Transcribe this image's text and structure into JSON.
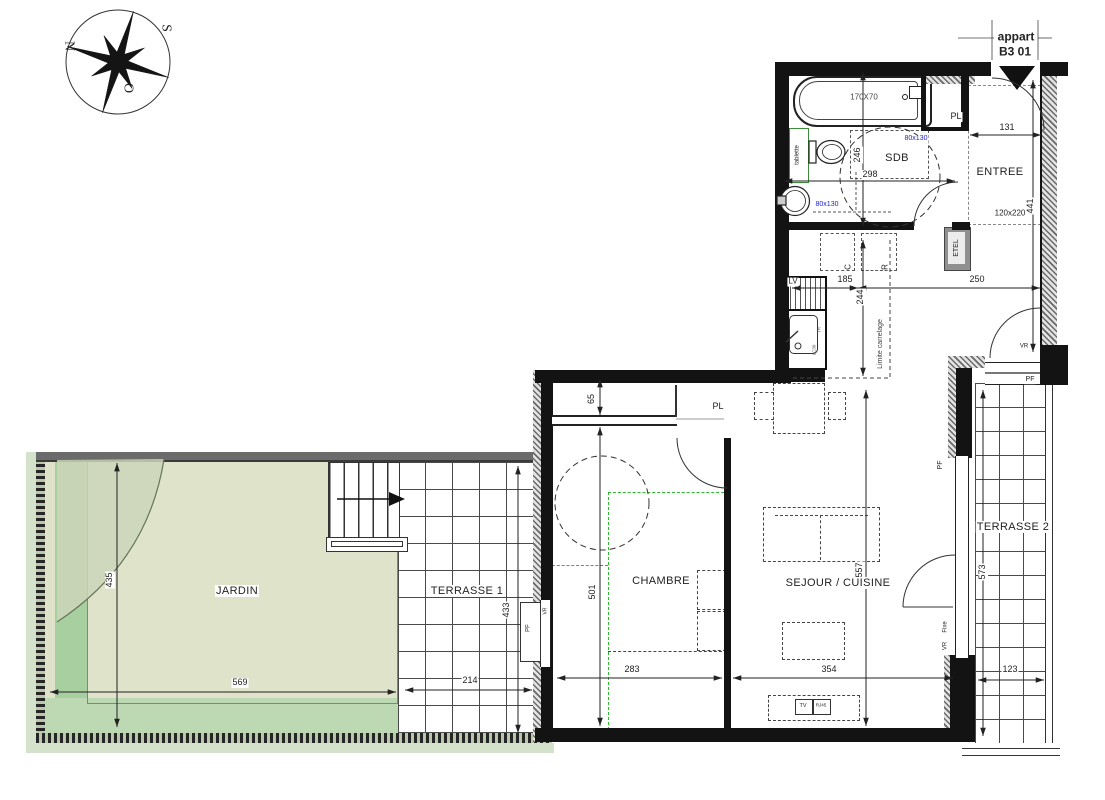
{
  "meta": {
    "apartment_line1": "appart",
    "apartment_line2": "B3 01"
  },
  "compass": {
    "n": "N",
    "s": "S",
    "o": "O"
  },
  "rooms": {
    "jardin": "JARDIN",
    "terrasse1": "TERRASSE 1",
    "terrasse2": "TERRASSE 2",
    "chambre": "CHAMBRE",
    "sejour": "SEJOUR / CUISINE",
    "sdb": "SDB",
    "entree": "ENTREE"
  },
  "dims": {
    "entree_width": "131",
    "entree_height": "441",
    "hall_width": "250",
    "sdb_width": "298",
    "sdb_height": "246",
    "kitchen_width": "185",
    "kitchen_depth": "244",
    "pl_depth": "65",
    "chambre_height": "501",
    "chambre_width": "283",
    "sejour_height": "557",
    "sejour_width": "354",
    "terrasse2_height": "573",
    "terrasse2_width": "123",
    "terrasse1_height": "433",
    "terrasse1_width": "214",
    "jardin_height": "435",
    "jardin_width": "569"
  },
  "fixtures": {
    "closet": "PL",
    "shelf": "tablette",
    "elec_panel": "ETEL",
    "dishwasher": "LV",
    "sink_code": "LC30",
    "sink_tr": "TR",
    "cooker": "C",
    "fridge": "R",
    "tile_limit": "Limite carrelage",
    "tv": "TV",
    "rj45": "RJ45",
    "window": "PF",
    "shutter": "VR",
    "fixed_pane": "Fixe",
    "bathtub_size": "170X70",
    "sdb_door_size": "80x130",
    "entree_mat_size": "120x220"
  },
  "colors": {
    "jardin": "#dfe3c9",
    "jardin_band": "#a8cfa0",
    "jardin_bottom": "#bcd9b4",
    "accent_blue": "#2323cc",
    "wall": "#111111"
  }
}
